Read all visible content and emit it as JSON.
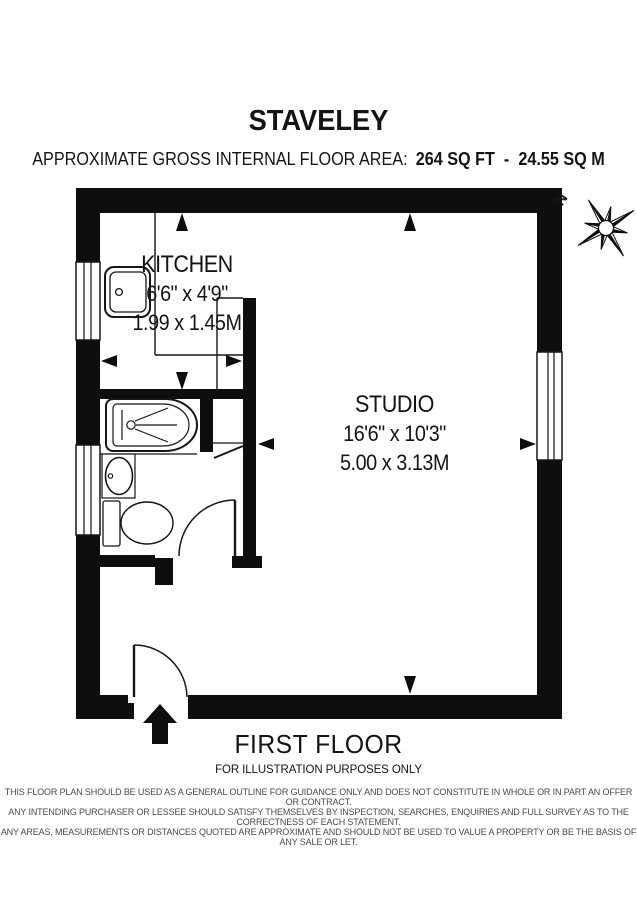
{
  "header": {
    "title": "STAVELEY",
    "area_label": "APPROXIMATE GROSS INTERNAL FLOOR AREA:",
    "area_value": "264 SQ FT  -  24.55 SQ M"
  },
  "compass": {
    "north_label": "N"
  },
  "rooms": {
    "kitchen": {
      "name": "KITCHEN",
      "dimensions_imperial": "6'6\" x 4'9\"",
      "dimensions_metric": "1.99 x 1.45M"
    },
    "studio": {
      "name": "STUDIO",
      "dimensions_imperial": "16'6\" x 10'3\"",
      "dimensions_metric": "5.00 x 3.13M"
    }
  },
  "footer": {
    "floor_label": "FIRST FLOOR",
    "illustration_note": "FOR ILLUSTRATION PURPOSES ONLY",
    "disclaimer_lines": [
      "THIS FLOOR PLAN SHOULD BE USED AS A GENERAL OUTLINE FOR GUIDANCE ONLY AND DOES NOT CONSTITUTE IN WHOLE OR IN PART AN OFFER OR CONTRACT.",
      "ANY INTENDING PURCHASER OR LESSEE SHOULD SATISFY THEMSELVES BY INSPECTION, SEARCHES, ENQUIRIES AND FULL SURVEY AS TO THE CORRECTNESS OF EACH STATEMENT.",
      "ANY AREAS, MEASUREMENTS OR DISTANCES QUOTED ARE APPROXIMATE AND SHOULD NOT BE USED TO VALUE A PROPERTY OR BE THE BASIS OF ANY SALE OR LET."
    ]
  },
  "colors": {
    "wall": "#0e0e0e",
    "line": "#161616",
    "disclaimer_text": "#4a4a4a"
  }
}
